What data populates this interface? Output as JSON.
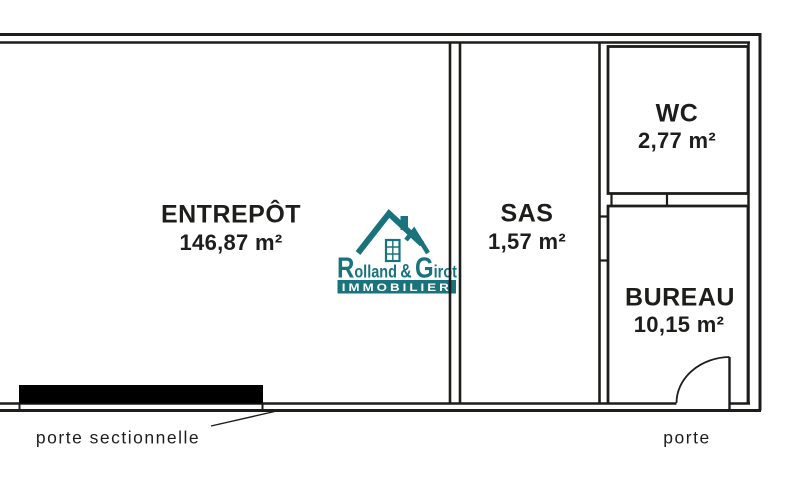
{
  "colors": {
    "line": "#1d1d1b",
    "brand": "#19737d",
    "black": "#000000"
  },
  "plan": {
    "rooms": [
      {
        "key": "entrepot",
        "name": "ENTREPÔT",
        "area": "146,87 m²"
      },
      {
        "key": "sas",
        "name": "SAS",
        "area": "1,57 m²"
      },
      {
        "key": "wc",
        "name": "WC",
        "area": "2,77 m²"
      },
      {
        "key": "bureau",
        "name": "BUREAU",
        "area": "10,15 m²"
      }
    ],
    "annotations": [
      {
        "key": "sectional-door",
        "label": "porte sectionnelle"
      },
      {
        "key": "door",
        "label": "porte"
      }
    ]
  },
  "logo": {
    "r_cap": "R",
    "r_rest": "olland",
    "amp": "&",
    "g_cap": "G",
    "g_rest": "irot",
    "banner": "IMMOBILIER"
  }
}
